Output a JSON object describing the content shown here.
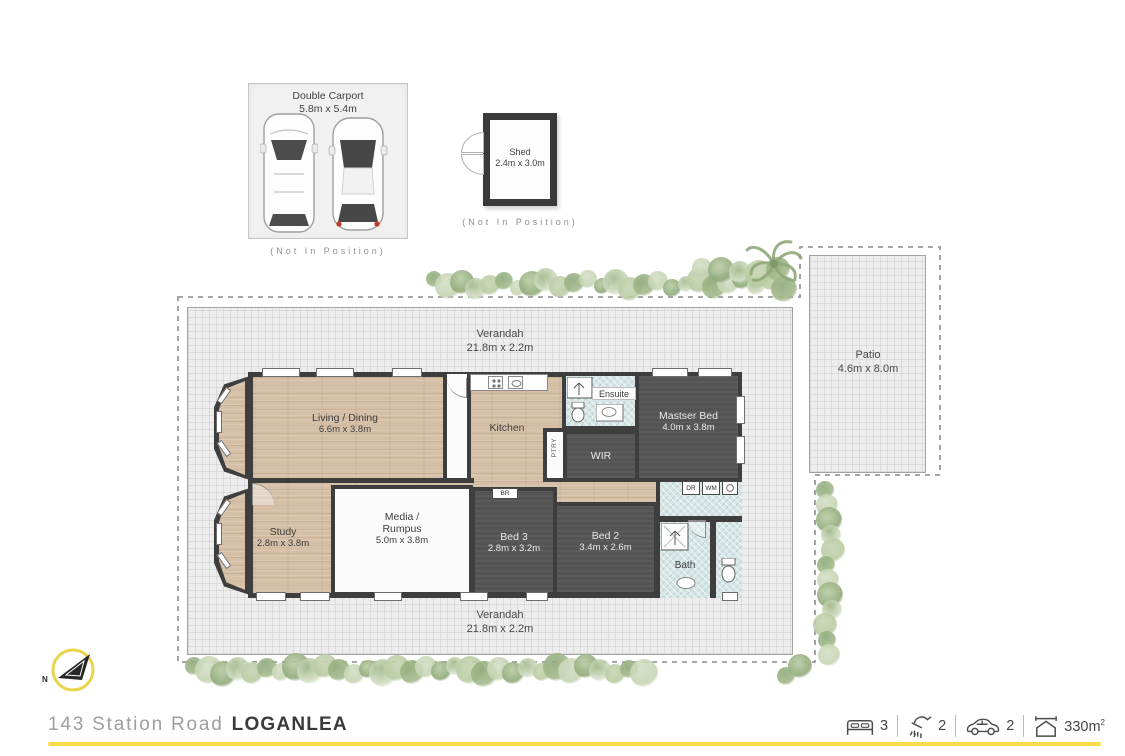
{
  "outbuildings": {
    "carport": {
      "title": "Double Carport",
      "dims": "5.8m x 5.4m",
      "note": "(Not In Position)"
    },
    "shed": {
      "title": "Shed",
      "dims": "2.4m x 3.0m",
      "note": "(Not In Position)"
    }
  },
  "plan": {
    "verandah_top": {
      "name": "Verandah",
      "dims": "21.8m x 2.2m"
    },
    "verandah_bottom": {
      "name": "Verandah",
      "dims": "21.8m x 2.2m"
    },
    "patio": {
      "name": "Patio",
      "dims": "4.6m x 8.0m"
    },
    "rooms": {
      "living": {
        "name": "Living / Dining",
        "dims": "6.6m x 3.8m"
      },
      "kitchen": {
        "name": "Kitchen"
      },
      "pantry": {
        "name": "PTRY"
      },
      "ensuite": {
        "name": "Ensuite"
      },
      "master": {
        "name": "Mastser Bed",
        "dims": "4.0m x 3.8m"
      },
      "wir": {
        "name": "WIR"
      },
      "study": {
        "name": "Study",
        "dims": "2.8m x 3.8m"
      },
      "media": {
        "line1": "Media /",
        "line2": "Rumpus",
        "dims": "5.0m x 3.8m"
      },
      "bed3": {
        "name": "Bed 3",
        "dims": "2.8m x 3.2m"
      },
      "bed2": {
        "name": "Bed 2",
        "dims": "3.4m x 2.6m"
      },
      "bath": {
        "name": "Bath"
      },
      "robe": {
        "name": "BR"
      },
      "dryer": {
        "name": "DR"
      },
      "washer": {
        "name": "WM"
      }
    }
  },
  "compass": {
    "label": "N"
  },
  "footer": {
    "street": "143 Station Road",
    "suburb": "LOGANLEA",
    "stats": [
      {
        "icon": "bed-icon",
        "value": "3"
      },
      {
        "icon": "shower-icon",
        "value": "2"
      },
      {
        "icon": "car-icon",
        "value": "2"
      },
      {
        "icon": "house-area-icon",
        "value": "330m",
        "sup": "2"
      }
    ]
  },
  "colors": {
    "accent_yellow": "#f6db4b",
    "wall": "#3e3e3e",
    "wood_floor": "#d5bfa6",
    "dark_room": "#545454",
    "tile_room": "#d6e5e5",
    "verandah_fill": "#ededed",
    "greenery": "#a3ba8c"
  }
}
